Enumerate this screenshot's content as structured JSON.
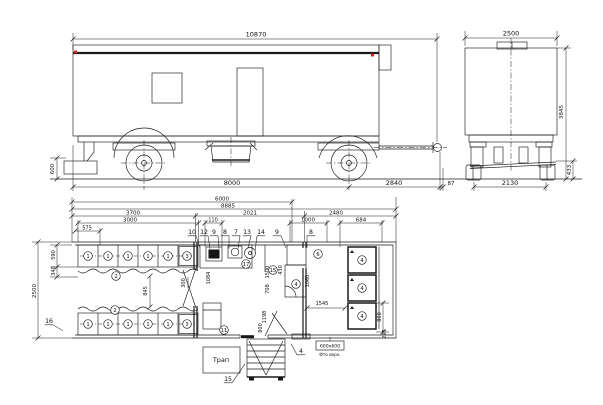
{
  "drawing": {
    "type": "technical drawing — trailer (vagon-house): side elevation, rear elevation, floor plan",
    "colors": {
      "line": "#1a1a1a",
      "accent_red": "#cc2222",
      "background": "#ffffff"
    }
  },
  "labels": {
    "dimensions": [
      {
        "t": "10870",
        "x": 256,
        "y": 36.5,
        "s": 6.5
      },
      {
        "t": "8000",
        "x": 232,
        "y": 185,
        "s": 6.5
      },
      {
        "t": "2840",
        "x": 394,
        "y": 185,
        "s": 6.5
      },
      {
        "t": "87",
        "x": 451,
        "y": 185,
        "s": 5.5
      },
      {
        "t": "600",
        "x": 54,
        "y": 169,
        "s": 5.5,
        "r": -90
      },
      {
        "t": "2500",
        "x": 511,
        "y": 35.5,
        "s": 6.5
      },
      {
        "t": "3845",
        "x": 563,
        "y": 112,
        "s": 5.5,
        "r": -90
      },
      {
        "t": "433",
        "x": 571,
        "y": 170,
        "s": 5.5,
        "r": -90
      },
      {
        "t": "2130",
        "x": 510,
        "y": 185,
        "s": 6.5
      },
      {
        "t": "6000",
        "x": 222,
        "y": 200.5,
        "s": 5.5
      },
      {
        "t": "8885",
        "x": 228,
        "y": 207.5,
        "s": 5.5
      },
      {
        "t": "3700",
        "x": 133,
        "y": 214.5,
        "s": 5.5
      },
      {
        "t": "2021",
        "x": 250,
        "y": 214.5,
        "s": 5.5
      },
      {
        "t": "2480",
        "x": 336,
        "y": 214.5,
        "s": 5.5
      },
      {
        "t": "3000",
        "x": 130,
        "y": 221.5,
        "s": 5.5
      },
      {
        "t": "110",
        "x": 213,
        "y": 221.5,
        "s": 5
      },
      {
        "t": "1000",
        "x": 308,
        "y": 221.5,
        "s": 5.5
      },
      {
        "t": "684",
        "x": 361,
        "y": 221.5,
        "s": 5.5
      },
      {
        "t": "575",
        "x": 87,
        "y": 229.5,
        "s": 5
      },
      {
        "t": "2500",
        "x": 36,
        "y": 291,
        "s": 5.5,
        "r": -90
      },
      {
        "t": "590",
        "x": 55,
        "y": 255,
        "s": 5,
        "r": -90
      },
      {
        "t": "340",
        "x": 55,
        "y": 271,
        "s": 5,
        "r": -90
      },
      {
        "t": "845",
        "x": 147,
        "y": 291,
        "s": 5,
        "r": -90
      },
      {
        "t": "300",
        "x": 185,
        "y": 283,
        "s": 5,
        "r": -90
      },
      {
        "t": "1084",
        "x": 210,
        "y": 278,
        "s": 5,
        "r": -90
      },
      {
        "t": "1500",
        "x": 269,
        "y": 272,
        "s": 5,
        "r": -90
      },
      {
        "t": "708",
        "x": 269,
        "y": 289,
        "s": 5,
        "r": -90
      },
      {
        "t": "430",
        "x": 282,
        "y": 270,
        "s": 5,
        "r": -90
      },
      {
        "t": "1060",
        "x": 309,
        "y": 281,
        "s": 5,
        "r": -90
      },
      {
        "t": "1198",
        "x": 266,
        "y": 317,
        "s": 5,
        "r": -90
      },
      {
        "t": "800",
        "x": 262,
        "y": 328,
        "s": 5,
        "r": -90
      },
      {
        "t": "1545",
        "x": 322,
        "y": 305,
        "s": 5
      },
      {
        "t": "800",
        "x": 381,
        "y": 317,
        "s": 5,
        "r": -90
      },
      {
        "t": "295",
        "x": 386,
        "y": 334,
        "s": 5,
        "r": -90
      }
    ],
    "callouts": [
      {
        "t": "10",
        "x": 192,
        "y": 234,
        "lx": 8,
        "ly": 12
      },
      {
        "t": "12",
        "x": 204,
        "y": 234,
        "lx": 6,
        "ly": 13
      },
      {
        "t": "9",
        "x": 214,
        "y": 234,
        "lx": 5,
        "ly": 13
      },
      {
        "t": "8",
        "x": 225,
        "y": 234,
        "lx": 4,
        "ly": 13
      },
      {
        "t": "7",
        "x": 236,
        "y": 234,
        "lx": 2,
        "ly": 13
      },
      {
        "t": "13",
        "x": 247,
        "y": 234,
        "lx": 1,
        "ly": 12
      },
      {
        "t": "14",
        "x": 261,
        "y": 234,
        "lx": -6,
        "ly": 15
      },
      {
        "t": "9",
        "x": 277,
        "y": 234,
        "lx": 9,
        "ly": 12
      },
      {
        "t": "8",
        "x": 311,
        "y": 234,
        "lx": -4,
        "ly": 12
      },
      {
        "t": "16",
        "x": 49,
        "y": 323,
        "lx": 14,
        "ly": 6
      },
      {
        "t": "15",
        "x": 228,
        "y": 381,
        "lx": 17,
        "ly": -19
      },
      {
        "t": "4",
        "x": 301,
        "y": 353,
        "lx": -10,
        "ly": -11
      }
    ],
    "circled_items": [
      {
        "t": "1",
        "x": 88,
        "y": 256
      },
      {
        "t": "1",
        "x": 108,
        "y": 256
      },
      {
        "t": "1",
        "x": 128,
        "y": 256
      },
      {
        "t": "1",
        "x": 148,
        "y": 256
      },
      {
        "t": "1",
        "x": 168,
        "y": 256
      },
      {
        "t": "3",
        "x": 187,
        "y": 256
      },
      {
        "t": "2",
        "x": 116,
        "y": 276
      },
      {
        "t": "2",
        "x": 115,
        "y": 310
      },
      {
        "t": "1",
        "x": 88,
        "y": 324
      },
      {
        "t": "1",
        "x": 108,
        "y": 324
      },
      {
        "t": "1",
        "x": 128,
        "y": 324
      },
      {
        "t": "1",
        "x": 148,
        "y": 324
      },
      {
        "t": "1",
        "x": 168,
        "y": 324
      },
      {
        "t": "3",
        "x": 187,
        "y": 324
      },
      {
        "t": "17",
        "x": 246,
        "y": 264
      },
      {
        "t": "15",
        "x": 273,
        "y": 270
      },
      {
        "t": "4",
        "x": 296,
        "y": 284
      },
      {
        "t": "6",
        "x": 318,
        "y": 254
      },
      {
        "t": "4",
        "x": 362,
        "y": 260
      },
      {
        "t": "4",
        "x": 362,
        "y": 288
      },
      {
        "t": "4",
        "x": 362,
        "y": 316
      },
      {
        "t": "11",
        "x": 224,
        "y": 330
      }
    ],
    "notes": [
      {
        "t": "Трап",
        "x": 221,
        "y": 362,
        "s": 6.5
      },
      {
        "t": "600х600",
        "x": 330,
        "y": 347.5,
        "s": 4.6
      },
      {
        "t": "Фто верх.",
        "x": 330,
        "y": 356,
        "s": 4.2
      }
    ]
  }
}
